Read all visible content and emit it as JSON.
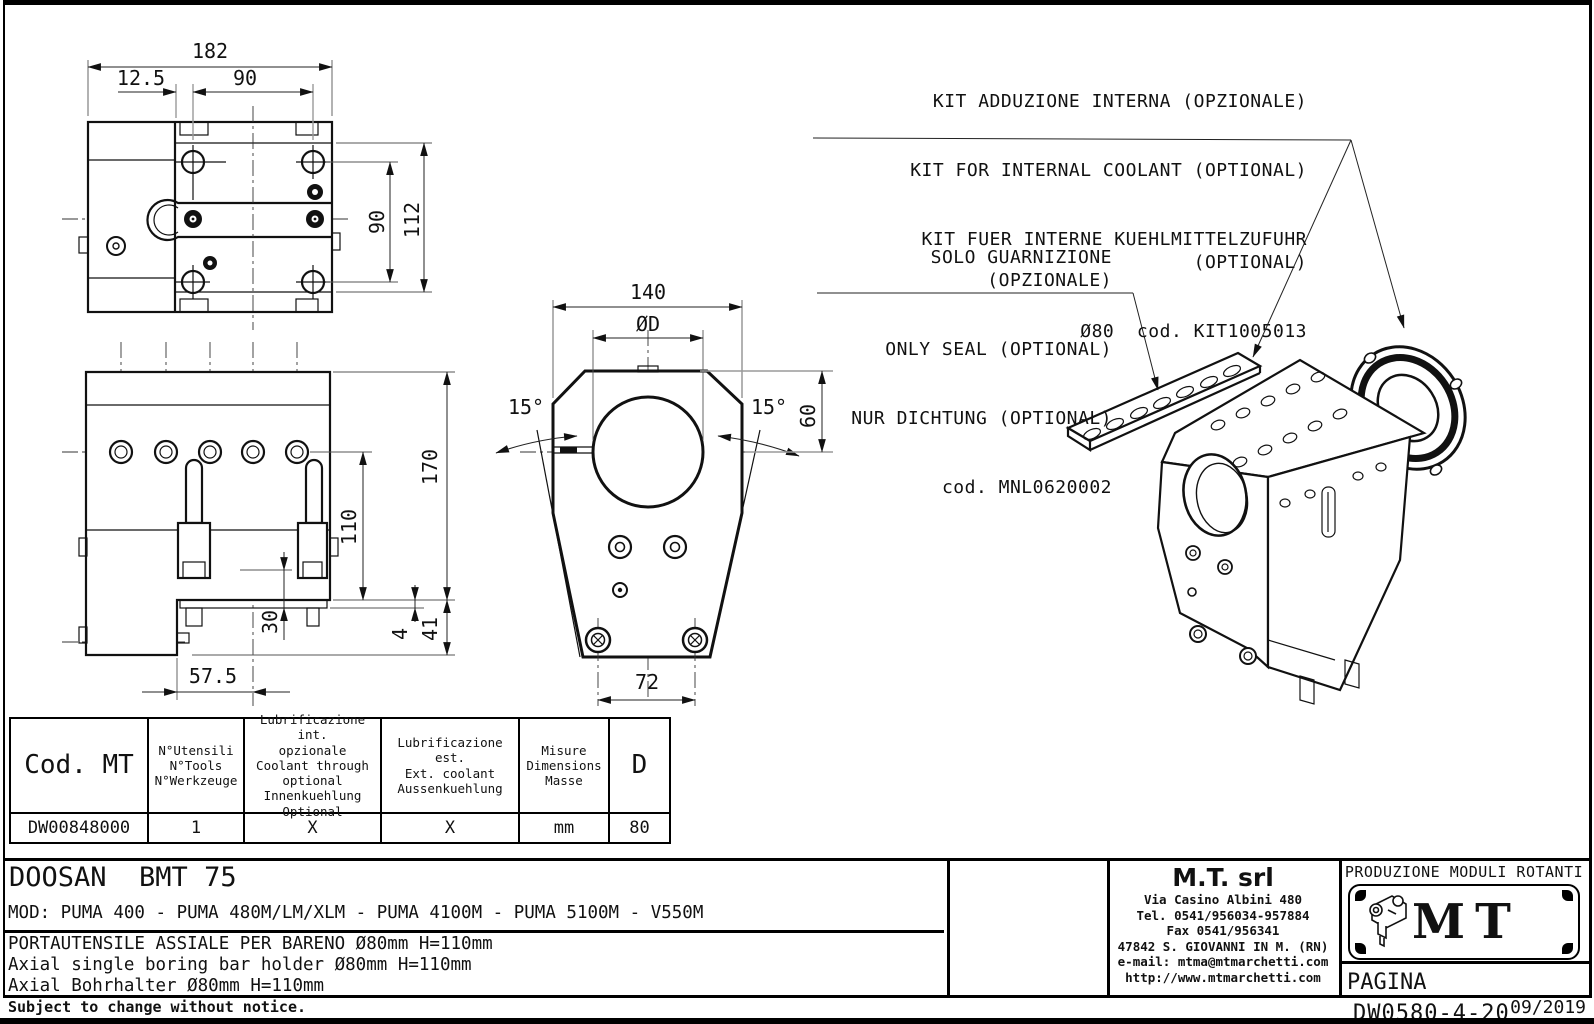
{
  "annotations": {
    "kit": {
      "line1": "KIT ADDUZIONE INTERNA (OPZIONALE)",
      "line2": "KIT FOR INTERNAL COOLANT (OPTIONAL)",
      "line3": "KIT FUER INTERNE KUEHLMITTELZUFUHR (OPTIONAL)",
      "line4": "Ø80  cod. KIT1005013"
    },
    "seal": {
      "line1": "SOLO GUARNIZIONE (OPZIONALE)",
      "line2": "ONLY SEAL (OPTIONAL)",
      "line3": "NUR DICHTUNG (OPTIONAL)",
      "line4": "cod. MNL0620002"
    }
  },
  "dimensions": {
    "top_view": {
      "overall_width": "182",
      "offset": "12.5",
      "hole_pitch_h": "90",
      "hole_pitch_v": "90",
      "overall_height": "112"
    },
    "front_view": {
      "overall_height": "170",
      "dim_110": "110",
      "dim_30": "30",
      "dim_4": "4",
      "dim_41": "41",
      "dim_57_5": "57.5"
    },
    "section_view": {
      "width": "140",
      "bore": "ØD",
      "angle_left": "15°",
      "angle_right": "15°",
      "dim_60": "60",
      "dim_72": "72"
    }
  },
  "table": {
    "headers": [
      "Cod. MT",
      "N°Utensili\nN°Tools\nN°Werkzeuge",
      "Lubrificazione int.\nopzionale\nCoolant through\noptional\nInnenkuehlung\nOptional",
      "Lubrificazione est.\nExt. coolant\nAussenkuehlung",
      "Misure\nDimensions\nMasse",
      "D"
    ],
    "row": [
      "DW00848000",
      "1",
      "X",
      "X",
      "mm",
      "80"
    ]
  },
  "title_block": {
    "model": "DOOSAN  BMT 75",
    "mod_line": "MOD: PUMA 400 - PUMA 480M/LM/XLM - PUMA 4100M - PUMA 5100M - V550M",
    "desc_it": "PORTAUTENSILE ASSIALE PER BARENO Ø80mm H=110mm",
    "desc_en": "Axial single boring bar holder Ø80mm H=110mm",
    "desc_de": "Axial Bohrhalter Ø80mm H=110mm"
  },
  "company": {
    "name": "M.T. srl",
    "address": "Via Casino Albini 480",
    "tel": "Tel. 0541/956034-957884",
    "fax": "Fax 0541/956341",
    "city": "47842 S. GIOVANNI IN M. (RN)",
    "email": "e-mail: mtma@mtmarchetti.com",
    "web": "http://www.mtmarchetti.com"
  },
  "logo": {
    "caption": "PRODUZIONE MODULI ROTANTI",
    "text": "MT"
  },
  "page": {
    "label": "PAGINA",
    "number": "DW0580-4-20"
  },
  "footer": {
    "notice": "Subject to change without notice.",
    "date": "09/2019"
  }
}
